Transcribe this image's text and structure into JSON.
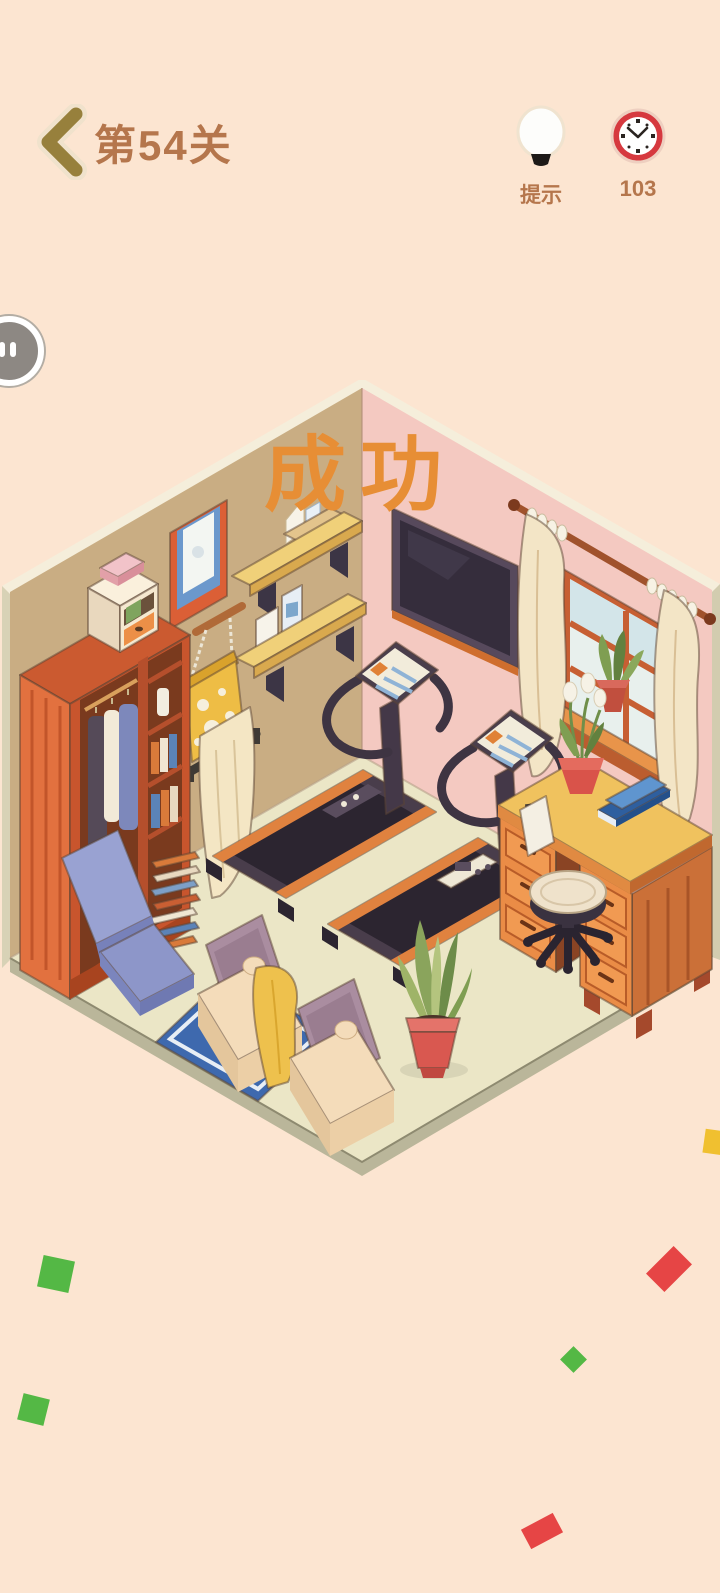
{
  "header": {
    "level_title": "第54关",
    "hint_label": "提示",
    "timer_value": "103"
  },
  "game": {
    "success_text": "成功"
  },
  "icons": {
    "back": "back-chevron-icon",
    "hint": "lightbulb-icon",
    "timer": "clock-icon",
    "pause": "pause-icon"
  },
  "palette": {
    "background": "#fce5d1",
    "header_text": "#b5764c",
    "back_chevron": "#97803c",
    "clock_red": "#d6393f",
    "success_orange": "#e78e35",
    "left_wall": "#c9ad83",
    "right_wall": "#f4c9c1",
    "floor": "#ebe6c6",
    "wardrobe_wood": "#d8693c",
    "desk_wood": "#ea8c46",
    "shelf_yellow": "#f0d079",
    "treadmill_dark": "#493d4b",
    "treadmill_accent": "#e0823f",
    "rug_blue": "#3e69ae",
    "chair_blue": "#8d96c9",
    "armchair_cream": "#f4dcba",
    "cushion_mauve": "#aa8da0",
    "blanket_yellow": "#eec14d",
    "plant_pot_red": "#d95850",
    "confetti_green": "#54b845",
    "confetti_red": "#e64545",
    "confetti_yellow": "#f0c030"
  },
  "confetti": [
    {
      "x": 40,
      "y": 1258,
      "w": 32,
      "h": 32,
      "rot": 12,
      "color": "#54b845"
    },
    {
      "x": 656,
      "y": 1256,
      "w": 26,
      "h": 26,
      "rot": 45,
      "color": "#e64545",
      "stretch": 1.5
    },
    {
      "x": 564,
      "y": 1350,
      "w": 19,
      "h": 19,
      "rot": 45,
      "color": "#54b845"
    },
    {
      "x": 20,
      "y": 1396,
      "w": 27,
      "h": 27,
      "rot": 14,
      "color": "#54b845"
    },
    {
      "x": 524,
      "y": 1520,
      "w": 36,
      "h": 22,
      "rot": -28,
      "color": "#e64545"
    },
    {
      "x": 704,
      "y": 1130,
      "w": 20,
      "h": 24,
      "rot": 8,
      "color": "#f0c030"
    }
  ]
}
